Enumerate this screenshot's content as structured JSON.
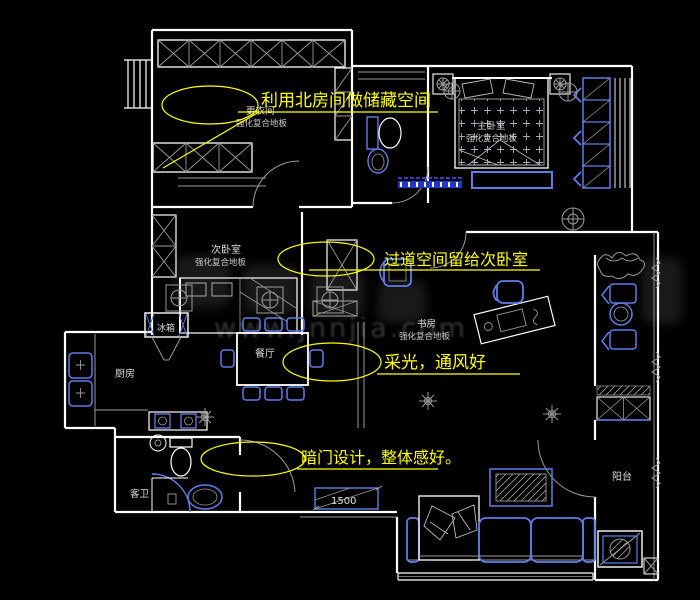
{
  "plan": {
    "rooms": {
      "dressing": {
        "name": "更衣间",
        "floor": "强化复合地板"
      },
      "master": {
        "name": "主卧室",
        "floor": "强化复合地板"
      },
      "second": {
        "name": "次卧室",
        "floor": "强化复合地板"
      },
      "study": {
        "name": "书房",
        "floor": "强化复合地板"
      },
      "kitchen": {
        "name": "厨房"
      },
      "dining": {
        "name": "餐厅"
      },
      "guest_bath": {
        "name": "客卫"
      },
      "balcony": {
        "name": "阳台"
      }
    },
    "fixtures": {
      "fridge_label": "冰箱"
    },
    "annotations": {
      "storage": "利用北房间做储藏空间",
      "corridor": "过道空间留给次卧室",
      "daylight": "采光，通风好",
      "hidden_door": "暗门设计，整体感好。"
    },
    "dimensions": {
      "entry_width": "1500"
    },
    "watermark": "www.jnnjia.com",
    "colors": {
      "background": "#000000",
      "wall": "#ffffff",
      "furniture": "#5f7de8",
      "threshold": "#2236cc",
      "detail": "#9a9a9a",
      "annotation": "#ffff00"
    }
  }
}
